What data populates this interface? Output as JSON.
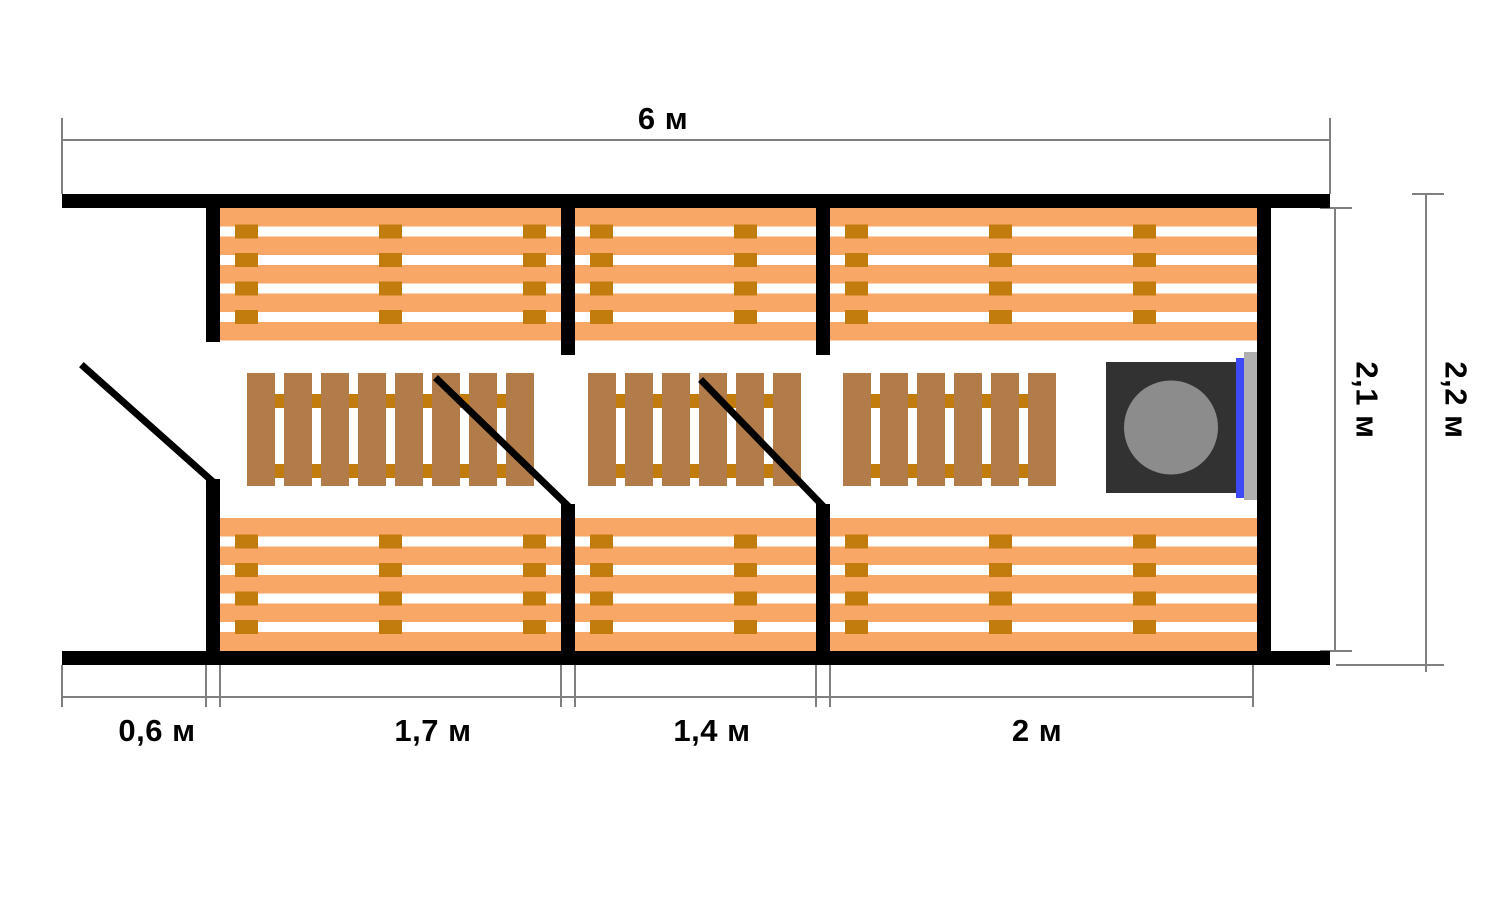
{
  "dimensions": {
    "total_length": "6 м",
    "inner_height": "2,1 м",
    "outer_height": "2,2 м",
    "segments": [
      {
        "label": "0,6 м"
      },
      {
        "label": "1,7 м"
      },
      {
        "label": "1,4 м"
      },
      {
        "label": "2 м"
      }
    ]
  },
  "colors": {
    "background": "#FFFFFF",
    "wall": "#000000",
    "bench": "#F9A766",
    "bench_gap": "#FFFFFF",
    "bench_cleat": "#C17C0D",
    "grate_plank": "#B27B4A",
    "grate_cleat": "#C17C0D",
    "stove_body": "#323232",
    "stove_lid": "#8C8C8C",
    "stove_screen_blue": "#3D4BF5",
    "stove_shield_gray": "#B0B0B0",
    "dimension_line": "#7F7F7F",
    "text": "#000000"
  }
}
